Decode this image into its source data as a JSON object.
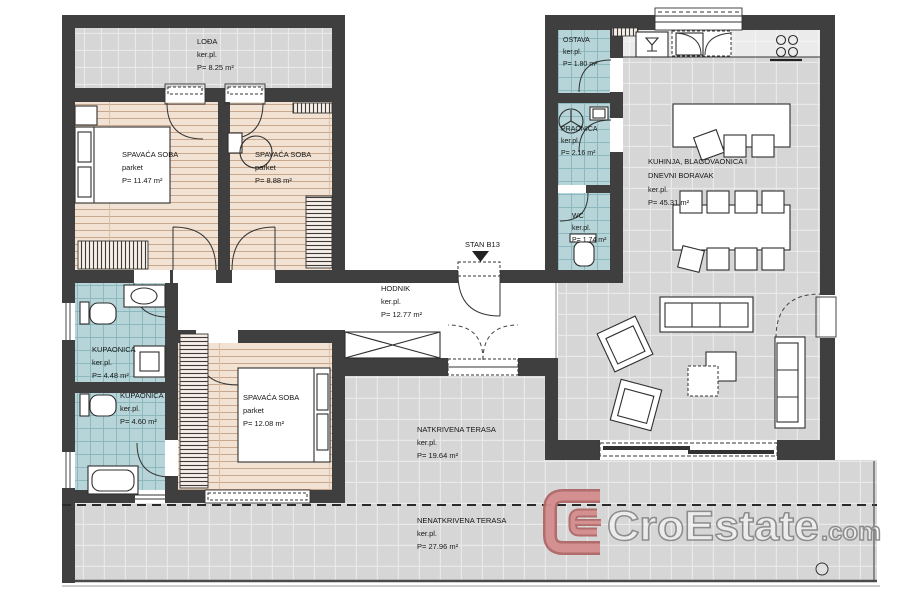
{
  "colors": {
    "wall": "#3f3f3f",
    "tile_gray": "#d6d6d6",
    "tile_gray_line": "#e9e9e9",
    "tile_blue": "#b7d5d9",
    "tile_blue_line": "#8cb9bd",
    "parquet": "#f1e2d3",
    "parquet_line": "#c9a78c",
    "hatch_bg": "#f7efe6",
    "line_dark": "#333333",
    "logo_red": "#d48d8d",
    "logo_red_dark": "#b06767",
    "logo_outline": "#8a8a8a"
  },
  "rooms": [
    {
      "name": "LOĐA",
      "floor": "ker.pl.",
      "area": "P= 8.25 m²"
    },
    {
      "name": "SPAVAĆA SOBA",
      "floor": "parket",
      "area": "P= 11.47 m²"
    },
    {
      "name": "SPAVAĆA SOBA",
      "floor": "parket",
      "area": "P= 8.88 m²"
    },
    {
      "name": "KUPAONICA",
      "floor": "ker.pl.",
      "area": "P= 4.48 m²"
    },
    {
      "name": "KUPAONICA",
      "floor": "ker.pl.",
      "area": "P= 4.60 m²"
    },
    {
      "name": "SPAVAĆA SOBA",
      "floor": "parket",
      "area": "P= 12.08 m²"
    },
    {
      "name": "HODNIK",
      "floor": "ker.pl.",
      "area": "P= 12.77 m²"
    },
    {
      "name": "OSTAVA",
      "floor": "ker.pl.",
      "area": "P= 1.80 m²"
    },
    {
      "name": "PRAONICA",
      "floor": "ker.pl.",
      "area": "P= 2.16 m²"
    },
    {
      "name": "WC",
      "floor": "ker.pl.",
      "area": "P= 1.74 m²"
    },
    {
      "name_line1": "KUHINJA, BLAGOVAONICA I",
      "name_line2": "DNEVNI BORAVAK",
      "floor": "ker.pl.",
      "area": "P= 45.31 m²"
    },
    {
      "name": "NATKRIVENA TERASA",
      "floor": "ker.pl.",
      "area": "P= 19.64 m²"
    },
    {
      "name": "NENATKRIVENA TERASA",
      "floor": "ker.pl.",
      "area": "P= 27.96 m²"
    }
  ],
  "entrance": {
    "label": "STAN B13"
  },
  "logo": {
    "brand": "CroEstate",
    "tld": ".com"
  },
  "icons": {
    "entrance_marker": "triangle-down",
    "washing_machine": "circle-with-spokes",
    "kitchen_sink": "glass-symbol",
    "stove": "four-burner-circles",
    "toilet": "bowl-with-tank",
    "bathtub": "rounded-rect",
    "shower": "nested-squares"
  }
}
